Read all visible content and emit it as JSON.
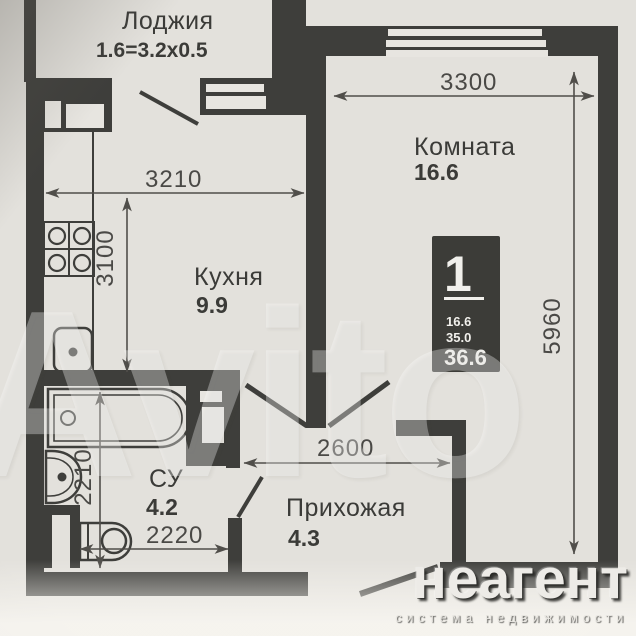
{
  "plan": {
    "rooms": {
      "loggia": {
        "label": "Лоджия",
        "area": "1.6=3.2x0.5"
      },
      "room": {
        "label": "Комната",
        "area": "16.6"
      },
      "kitchen": {
        "label": "Кухня",
        "area": "9.9"
      },
      "bathroom": {
        "label": "СУ",
        "area": "4.2"
      },
      "hallway": {
        "label": "Прихожая",
        "area": "4.3"
      }
    },
    "dimensions_mm": {
      "room_width": "3300",
      "kitchen_width": "3210",
      "kitchen_depth": "3100",
      "apartment_depth": "5960",
      "hallway_width": "2600",
      "bathroom_depth": "2210",
      "bathroom_width": "2220"
    },
    "info_badge": {
      "rooms_count": "1",
      "living_area": "16.6",
      "mid_area": "35.0",
      "total_area": "36.6"
    }
  },
  "branding": {
    "watermark": "Avito",
    "logo": "неагент",
    "tagline": "система недвижимости"
  },
  "colors": {
    "paper": "#e3e1dc",
    "wall": "#3e3e3b",
    "dimension": "#4a4946",
    "badge_bg": "#3c3c38",
    "logo_text": "#edebe7"
  }
}
